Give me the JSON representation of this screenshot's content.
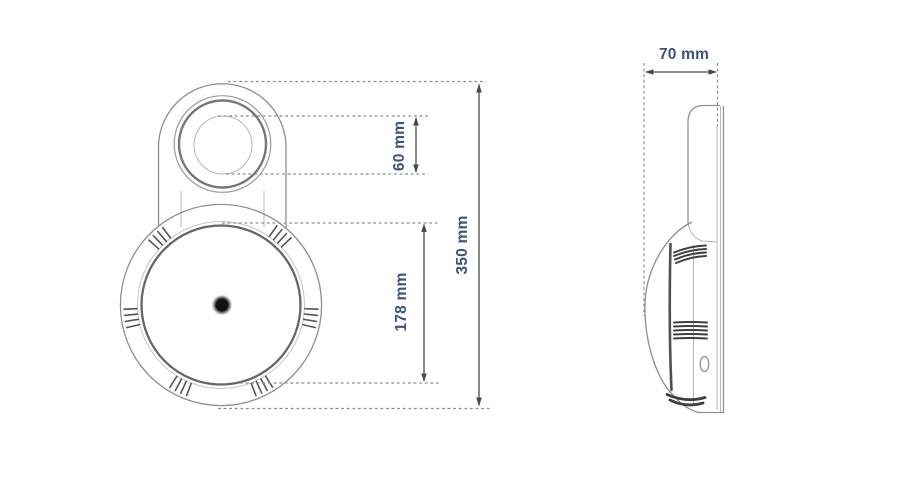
{
  "figure": {
    "views": {
      "front": {
        "dimensions": {
          "lens_diameter": "60 mm",
          "inner_face_diameter": "178 mm",
          "overall_height": "350 mm"
        }
      },
      "side": {
        "dimensions": {
          "depth": "70 mm"
        }
      }
    },
    "colors": {
      "background": "#ffffff",
      "outline": "#8e8e8e",
      "dark_detail": "#3f3f3f",
      "dimension_line": "#4a4a4a",
      "dimension_text": "#3d5377"
    }
  }
}
